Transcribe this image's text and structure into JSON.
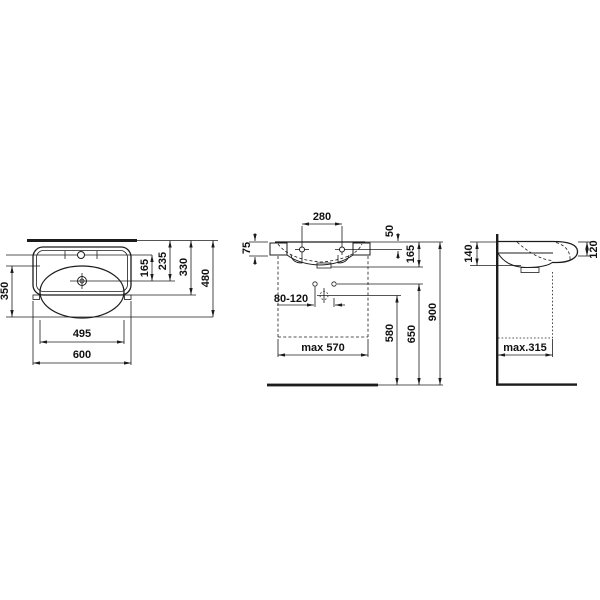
{
  "drawing": {
    "type": "washbasin-dimension-drawing",
    "background_color": "#ffffff",
    "line_color": "#1c1c1c",
    "views": [
      "top-view",
      "front-view",
      "side-view"
    ]
  },
  "dims": {
    "top": {
      "d350": "350",
      "d495": "495",
      "d600": "600",
      "d165": "165",
      "d235": "235",
      "d330": "330",
      "d480": "480"
    },
    "front": {
      "d280": "280",
      "d75": "75",
      "d50": "50",
      "d165": "165",
      "d80_120": "80-120",
      "dmax570": "max 570",
      "d580": "580",
      "d650": "650",
      "d900": "900"
    },
    "side": {
      "d140": "140",
      "d120": "120",
      "dmax315": "max.315"
    }
  }
}
